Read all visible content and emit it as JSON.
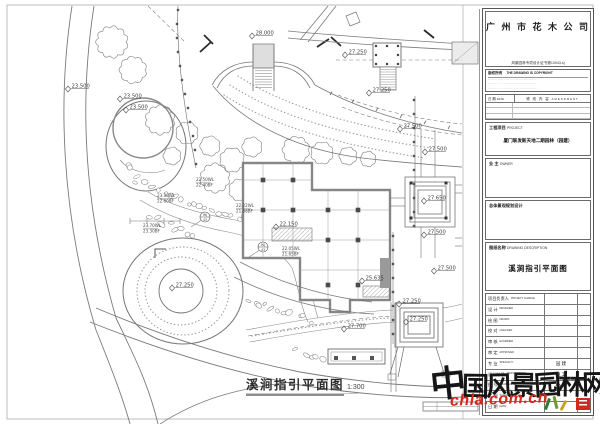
{
  "plan": {
    "title": "溪涧指引平面图",
    "scale": "1:300",
    "spot_elevations": [
      {
        "v": "28.000",
        "x": 252,
        "y": 31
      },
      {
        "v": "27.250",
        "x": 345,
        "y": 50
      },
      {
        "v": "27.250",
        "x": 369,
        "y": 88
      },
      {
        "v": "23.500",
        "x": 68,
        "y": 84
      },
      {
        "v": "23.500",
        "x": 120,
        "y": 94
      },
      {
        "v": "23.500",
        "x": 126,
        "y": 105
      },
      {
        "v": "27.500",
        "x": 400,
        "y": 124
      },
      {
        "v": "27.500",
        "x": 425,
        "y": 147
      },
      {
        "v": "27.650",
        "x": 424,
        "y": 196
      },
      {
        "v": "27.500",
        "x": 424,
        "y": 230
      },
      {
        "v": "27.500",
        "x": 434,
        "y": 266
      },
      {
        "v": "25.635",
        "x": 362,
        "y": 276
      },
      {
        "v": "27.250",
        "x": 172,
        "y": 283
      },
      {
        "v": "22.150",
        "x": 276,
        "y": 222
      },
      {
        "v": "27.700",
        "x": 344,
        "y": 324
      },
      {
        "v": "27.250",
        "x": 399,
        "y": 299
      },
      {
        "v": "27.250",
        "x": 406,
        "y": 317
      }
    ],
    "water_labels": [
      {
        "wl": "23.30WL",
        "bf": "22.80BF",
        "x": 157,
        "y": 197
      },
      {
        "wl": "22.50WL",
        "bf": "22.40BF",
        "x": 196,
        "y": 181
      },
      {
        "wl": "22.22WL",
        "bf": "21.88BF",
        "x": 236,
        "y": 207
      },
      {
        "wl": "23.70WL",
        "bf": "23.30BF",
        "x": 143,
        "y": 227
      },
      {
        "wl": "22.05WL",
        "bf": "21.65BF",
        "x": 282,
        "y": 250
      }
    ],
    "callouts": [
      {
        "label": "WJ-43",
        "x": 205,
        "y": 217
      },
      {
        "label": "WJ-43",
        "x": 263,
        "y": 247
      }
    ]
  },
  "titleblock": {
    "company": "广 州 市 花 木 公 司",
    "certificate": "风景园林专项设计证书第10043-sj",
    "contact_lines": [
      "AD.广州市…………………………",
      "TEL.020-………… ………… …………",
      "FAX.020-…………",
      "E-mail.……………@……………"
    ],
    "copyright": {
      "cn": "版权所有",
      "en": "THE DRAWING IS COPYRIGHT",
      "lines": [
        "………… ……………………………………",
        "………… ……………………………………",
        "………… ……………………………………"
      ]
    },
    "revision": {
      "date_label": "日 期",
      "date_en": "DATE",
      "amendment_label": "修 改 内 容",
      "amendment_en": "AMENDMENT",
      "empty_rows": 4
    },
    "project": {
      "label": "工程项目",
      "en": "PROJECT",
      "value": "厦门联发新天地二期园林（园建）"
    },
    "owner": {
      "label": "业 主",
      "en": "OWNER",
      "value": ""
    },
    "planning": {
      "label": "总体景观规划设计",
      "value": ""
    },
    "drawing": {
      "label": "图纸名称",
      "en": "DRAWING DESCRIPTION",
      "value": "溪涧指引平面图"
    },
    "personnel": [
      {
        "cn": "项目负责人",
        "en": "PROJECT CHARGE",
        "value": ""
      },
      {
        "cn": "设 计",
        "en": "DESIGNED",
        "value": ""
      },
      {
        "cn": "绘 图",
        "en": "DRAWN",
        "value": ""
      },
      {
        "cn": "校 对",
        "en": "CHECKED",
        "value": ""
      },
      {
        "cn": "审 核",
        "en": "EXAMINED",
        "value": ""
      },
      {
        "cn": "审 定",
        "en": "APPROVED",
        "value": ""
      },
      {
        "cn": "专 业",
        "en": "SPECIALTY",
        "value": "园 建"
      },
      {
        "cn": "设计阶段",
        "en": "DESIGN STAGE",
        "value": "施 工"
      },
      {
        "cn": "图 号",
        "en": "DRAWING NO.",
        "value": "A0-43"
      },
      {
        "cn": "比 例",
        "en": "SCALE",
        "value": ""
      },
      {
        "cn": "日 期",
        "en": "DATE",
        "value": ""
      }
    ]
  },
  "watermark": {
    "text": "中国风景园林网",
    "url": "chla.com.cn",
    "text_color": "#161616",
    "url_color": "#d3291e"
  }
}
